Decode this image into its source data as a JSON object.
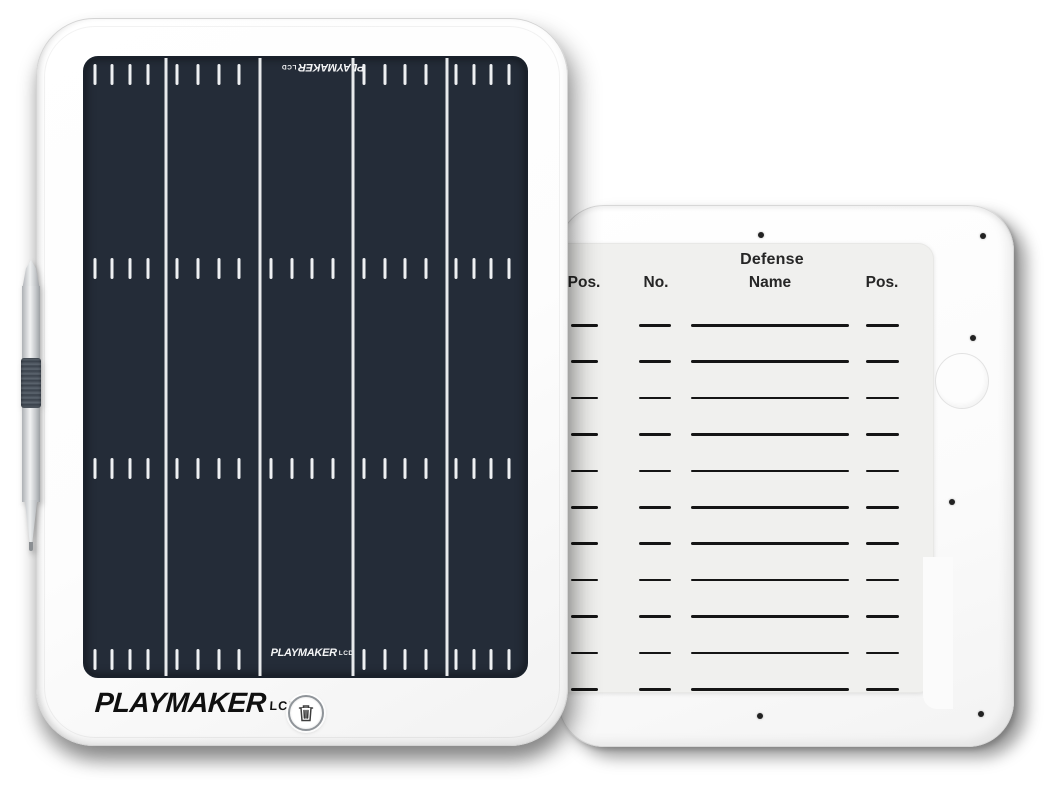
{
  "product": {
    "type": "LCD coaching tablet product photo",
    "background_color": "#ffffff"
  },
  "front_tablet": {
    "body_color": "#ffffff",
    "brand": "PLAYMAKER",
    "brand_suffix": "LCD",
    "screen": {
      "background_color": "#242c38",
      "marking_color": "#edeff1",
      "logo_text": "PLAYMAKER",
      "logo_suffix": "LCD",
      "field": {
        "yard_line_positions_pct": [
          18.3,
          39.7,
          60.8,
          82.0
        ],
        "columns": 5,
        "ticks_per_column": 4,
        "tick_fractions": [
          0.12,
          0.34,
          0.56,
          0.78
        ],
        "hash_band_tops_px": [
          6,
          200,
          400,
          591
        ],
        "edge_bands_skip_middle_column": true
      }
    },
    "erase_button": {
      "icon": "trash-icon",
      "ring_color": "#8f9499",
      "icon_color": "#3d3d3d"
    }
  },
  "back_tablet": {
    "body_color": "#fbfbfb",
    "screw_count": 6,
    "roster_card": {
      "card_color": "#f0f0ee",
      "line_color": "#151515",
      "title": "Defense",
      "columns": [
        "Pos.",
        "No.",
        "Name",
        "Pos."
      ],
      "row_count": 11
    }
  },
  "stylus": {
    "body_color": "silver",
    "grip_color": "#4a525c"
  }
}
